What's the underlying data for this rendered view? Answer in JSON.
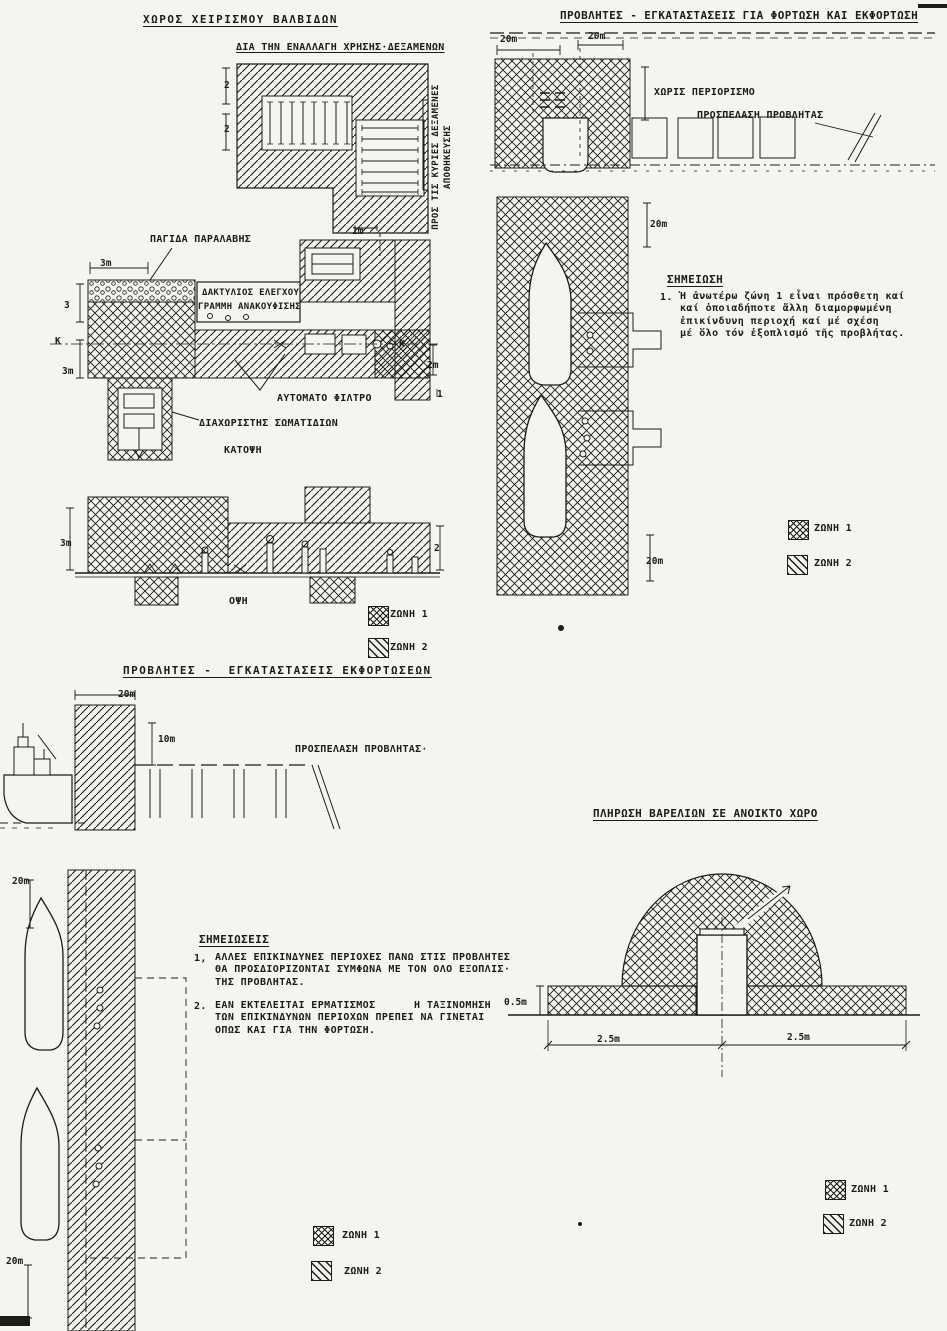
{
  "page": {
    "background": "#f5f4ef",
    "ink": "#1b1b1b"
  },
  "valve_area": {
    "title": "ΧΩΡΟΣ ΧΕΙΡΙΣΜΟΥ ΒΑΛΒΙΔΩΝ",
    "tank_switch_label": "ΔΙΑ ΤΗΝ ΕΝΑΛΛΑΓΗ ΧΡΗΣΗΣ·ΔΕΞΑΜΕΝΩΝ",
    "to_main_tanks_line1": "ΠΡΟΣ ΤΙΣ ΚΥΡΙΕΣ ΔΕΞΑΜΕΝΕΣ",
    "to_main_tanks_line2": "ΑΠΟΘΗΚΕΥΣΗΣ",
    "receiving_trap_label": "ΠΑΓΙΔΑ ΠΑΡΑΛΑΒΗΣ",
    "control_ring_label": "ΔΑΚΤΥΛΙΟΣ ΕΛΕΓΧΟΥ",
    "relief_line_label": "ΓΡΑΜΜΗ ΑΝΑΚΟΥΦΙΣΗΣ",
    "auto_filter_label": "ΑΥΤΟΜΑΤΟ ΦΙΛΤΡΟ",
    "particle_separator_label": "ΔΙΑΧΩΡΙΣΤΗΣ ΣΩΜΑΤΙΔΙΩΝ",
    "plan_caption": "ΚΑΤΟΨΗ",
    "elevation_caption": "ΟΨΗ",
    "dims": {
      "d2a": "2",
      "d2b": "2",
      "d1m": "1m",
      "d3m_top": "3m",
      "d3_left": "3",
      "dk_left": "Κ",
      "d3m_left2": "3m",
      "dk_right": "Κ",
      "d2m_right": "2m",
      "d1": "1",
      "d3m_elev": "3m",
      "d2_elev": "2"
    },
    "legend": {
      "zone1": "ΖΩΝΗ 1",
      "zone2": "ΖΩΝΗ 2"
    }
  },
  "loading_piers": {
    "title": "ΠΡΟΒΛΗΤΕΣ - ΕΓΚΑΤΑΣΤΑΣΕΙΣ ΓΙΑ ΦΟΡΤΩΣΗ ΚΑΙ ΕΚΦΟΡΤΩΣΗ",
    "no_restriction_label": "ΧΩΡΙΣ ΠΕΡΙΟΡΙΣΜΟ",
    "pier_access_label": "ΠΡΟΣΠΕΛΑΣΗ ΠΡΟΒΛΗΤΑΣ",
    "dims": {
      "d20a": "20m",
      "d20b": "20m",
      "d20c": "20m",
      "d20d": "20m"
    },
    "note": {
      "title": "ΣΗΜΕΙΩΣΗ",
      "number": "1.",
      "lines": [
        "Ἡ ἀνωτέρω ζώνη 1 εἶναι πρόσθετη καί",
        "καί ὁποιαδήποτε ἄλλη διαμορφωμένη",
        "ἐπικίνδυνη περιοχή καί μέ σχέση",
        "μέ ὅλο τόν ἐξοπλισμό τῆς προβλήτας."
      ]
    },
    "legend": {
      "zone1": "ΖΩΝΗ 1",
      "zone2": "ΖΩΝΗ 2"
    }
  },
  "unloading_piers": {
    "title": "ΠΡΟΒΛΗΤΕΣ -  ΕΓΚΑΤΑΣΤΑΣΕΙΣ ΕΚΦΟΡΤΩΣΕΩΝ",
    "pier_access_label": "ΠΡΟΣΠΕΛΑΣΗ ΠΡΟΒΛΗΤΑΣ·",
    "dims": {
      "d20": "20m",
      "d10": "10m",
      "d20_top": "20m",
      "d20_bottom": "20m"
    },
    "notes": {
      "title": "ΣΗΜΕΙΩΣΕΙΣ",
      "note1": {
        "number": "1,",
        "lines": [
          "ΑΛΛΕΣ ΕΠΙΚΙΝΔΥΝΕΣ ΠΕΡΙΟΧΕΣ ΠΑΝΩ ΣΤΙΣ ΠΡΟΒΛΗΤΕΣ",
          "ΘΑ ΠΡΟΣΔΙΟΡΙΖΟΝΤΑΙ ΣΥΜΦΩΝΑ ΜΕ ΤΟΝ ΟΛΟ ΕΞΟΠΛΙΣ·",
          "ΤΗΣ ΠΡΟΒΛΗΤΑΣ."
        ]
      },
      "note2": {
        "number": "2.",
        "lines": [
          "ΕΑΝ ΕΚΤΕΛΕΙΤΑΙ ΕΡΜΑΤΙΣΜΟΣ      Η ΤΑΞΙΝΟΜΗΣΗ",
          "ΤΩΝ ΕΠΙΚΙΝΔΥΝΩΝ ΠΕΡΙΟΧΩΝ ΠΡΕΠΕΙ ΝΑ ΓΙΝΕΤΑΙ",
          "ΟΠΩΣ ΚΑΙ ΓΙΑ ΤΗΝ ΦΟΡΤΩΣΗ."
        ]
      }
    },
    "legend": {
      "zone1": "ΖΩΝΗ 1",
      "zone2": "ΖΩΝΗ 2"
    }
  },
  "barrel_filling": {
    "title": "ΠΛΗΡΩΣΗ ΒΑΡΕΛΙΩΝ ΣΕ ΑΝΟΙΚΤΟ ΧΩΡΟ",
    "dims": {
      "d05": "0.5m",
      "d25_left": "2.5m",
      "d25_right": "2.5m"
    },
    "legend": {
      "zone1": "ΖΩΝΗ 1",
      "zone2": "ΖΩΝΗ 2"
    }
  }
}
